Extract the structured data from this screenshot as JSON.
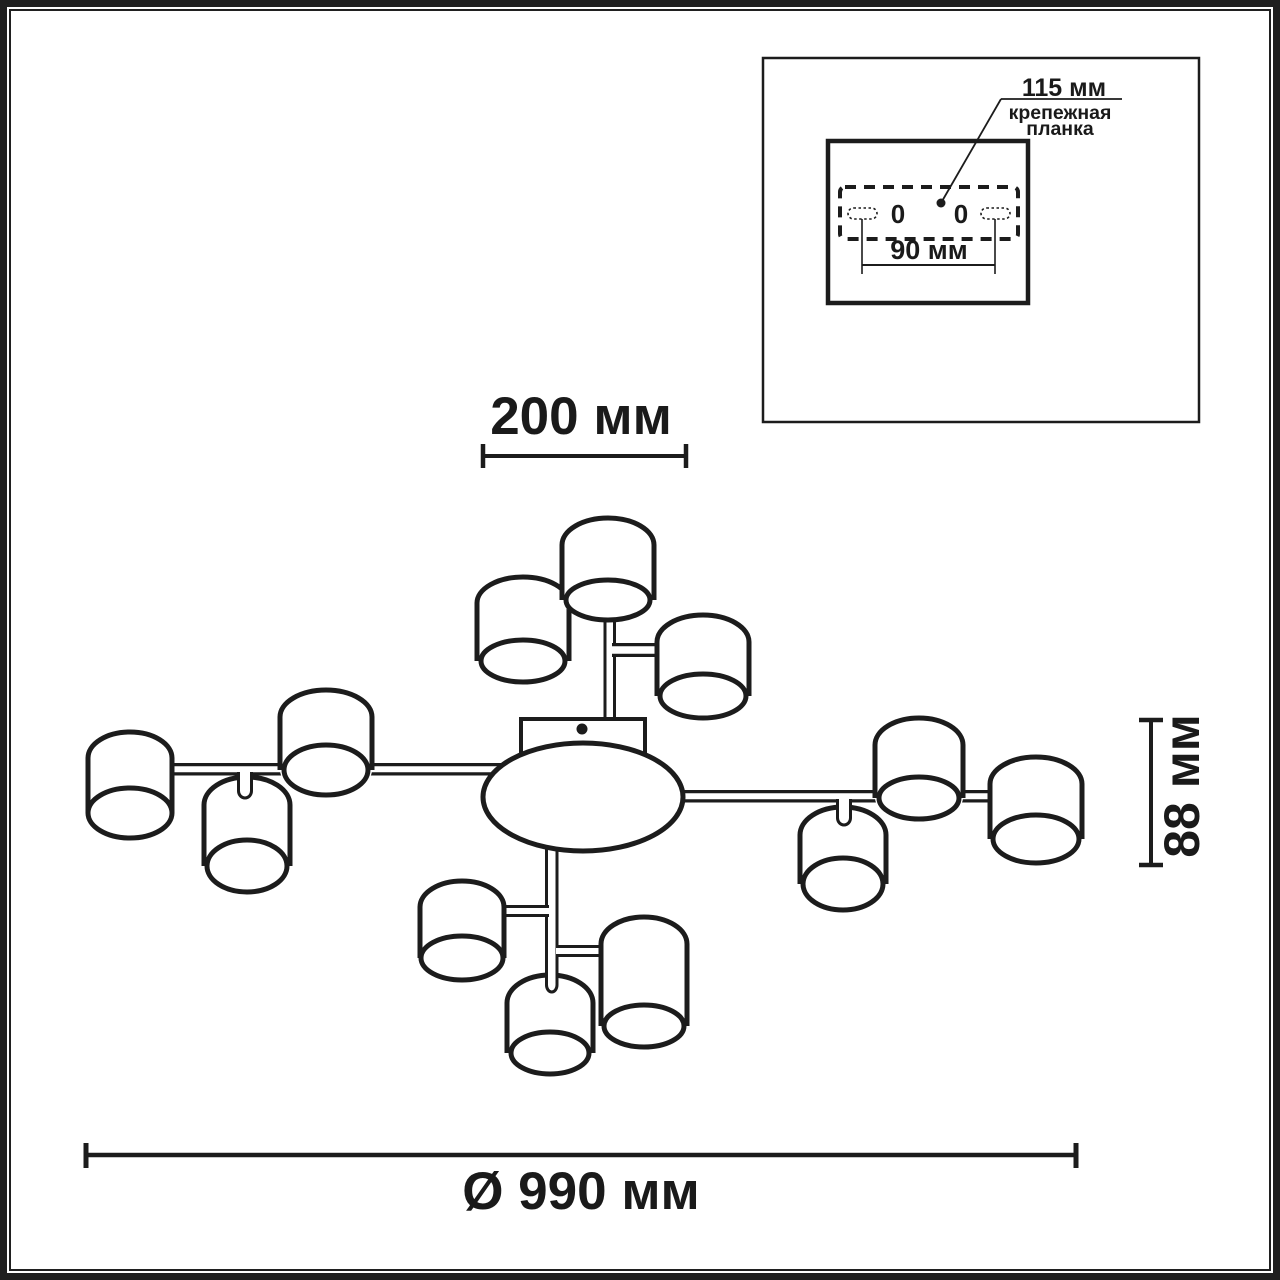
{
  "inset": {
    "hole_distance_label": "115 мм",
    "mount_label": "крепежная\nпланка",
    "span_label": "90 мм",
    "zero_marks": [
      "0",
      "0"
    ]
  },
  "dimensions": {
    "top_width": "200 мм",
    "shade_height": "88 мм",
    "diameter": "Ø 990 мм"
  },
  "drawing": {
    "stroke_color": "#1c1c1c",
    "background": "#ffffff",
    "primitives": [
      {
        "t": "rect",
        "name": "inset-box",
        "x": 763,
        "y": 58,
        "w": 436,
        "h": 364,
        "sw": 2.5,
        "fill": "#ffffff"
      },
      {
        "t": "rect",
        "name": "mount-plate-box",
        "x": 828,
        "y": 141,
        "w": 200,
        "h": 162,
        "sw": 4.5,
        "fill": "#ffffff"
      },
      {
        "t": "rect",
        "name": "mount-plate-dashed-outline",
        "x": 840,
        "y": 187,
        "w": 178,
        "h": 52,
        "sw": 4,
        "rx": 5,
        "dash": "11,8",
        "fill": "#ffffff"
      },
      {
        "t": "rect",
        "name": "mount-slot-left",
        "x": 848,
        "y": 208,
        "w": 29,
        "h": 11,
        "rx": 5.5,
        "sw": 1.6,
        "dash": "2.5,2.5",
        "fill": "#ffffff"
      },
      {
        "t": "rect",
        "name": "mount-slot-right",
        "x": 981,
        "y": 208,
        "w": 29,
        "h": 11,
        "rx": 5.5,
        "sw": 1.6,
        "dash": "2.5,2.5",
        "fill": "#ffffff"
      },
      {
        "t": "line",
        "name": "span-ext-line-left",
        "x1": 862,
        "y1": 219,
        "x2": 862,
        "y2": 274,
        "sw": 1.6
      },
      {
        "t": "line",
        "name": "span-ext-line-right",
        "x1": 995,
        "y1": 219,
        "x2": 995,
        "y2": 274,
        "sw": 1.6
      },
      {
        "t": "line",
        "name": "span-dim-line",
        "x1": 862,
        "y1": 265,
        "x2": 995,
        "y2": 265,
        "sw": 2
      },
      {
        "t": "line",
        "name": "leader-diagonal",
        "x1": 941,
        "y1": 203,
        "x2": 1001,
        "y2": 99,
        "sw": 1.8
      },
      {
        "t": "line",
        "name": "leader-horizontal",
        "x1": 1001,
        "y1": 99,
        "x2": 1122,
        "y2": 99,
        "sw": 1.8
      },
      {
        "t": "circle",
        "name": "leader-dot",
        "cx": 941,
        "cy": 203,
        "r": 4.5
      },
      {
        "t": "line",
        "name": "dim-top-line",
        "x1": 483,
        "y1": 456,
        "x2": 686,
        "y2": 456,
        "sw": 4
      },
      {
        "t": "line",
        "name": "dim-top-tick-left",
        "x1": 483,
        "y1": 444,
        "x2": 483,
        "y2": 468,
        "sw": 4.5
      },
      {
        "t": "line",
        "name": "dim-top-tick-right",
        "x1": 686,
        "y1": 444,
        "x2": 686,
        "y2": 468,
        "sw": 4.5
      },
      {
        "t": "line",
        "name": "dim-bottom-line",
        "x1": 86,
        "y1": 1155,
        "x2": 1076,
        "y2": 1155,
        "sw": 4.5
      },
      {
        "t": "line",
        "name": "dim-bottom-tick-left",
        "x1": 86,
        "y1": 1143,
        "x2": 86,
        "y2": 1168,
        "sw": 5
      },
      {
        "t": "line",
        "name": "dim-bottom-tick-right",
        "x1": 1076,
        "y1": 1143,
        "x2": 1076,
        "y2": 1168,
        "sw": 5
      },
      {
        "t": "line",
        "name": "dim-side-line",
        "x1": 1151,
        "y1": 720,
        "x2": 1151,
        "y2": 865,
        "sw": 4
      },
      {
        "t": "line",
        "name": "dim-side-tick-top",
        "x1": 1139,
        "y1": 720,
        "x2": 1163,
        "y2": 720,
        "sw": 4.5
      },
      {
        "t": "line",
        "name": "dim-side-tick-bottom",
        "x1": 1139,
        "y1": 865,
        "x2": 1163,
        "y2": 865,
        "sw": 4.5
      },
      {
        "t": "bar",
        "o": "h",
        "name": "arm-left",
        "x1": 160,
        "x2": 545,
        "y": 763,
        "th": 12.5,
        "sw": 3.2
      },
      {
        "t": "bar",
        "o": "h",
        "name": "arm-right",
        "x1": 640,
        "x2": 1050,
        "y": 790,
        "th": 12.5,
        "sw": 3.2
      },
      {
        "t": "bar",
        "o": "v",
        "name": "stem-top",
        "x": 603.5,
        "y1": 596,
        "y2": 730,
        "th": 12.5,
        "sw": 3
      },
      {
        "t": "bar",
        "o": "v",
        "name": "stem-bottom",
        "x": 545,
        "y1": 840,
        "y2": 982,
        "th": 13.5,
        "sw": 3
      },
      {
        "t": "bar",
        "o": "h",
        "name": "arm-top-right",
        "x1": 612,
        "x2": 700,
        "y": 643,
        "th": 14,
        "sw": 3.2
      },
      {
        "t": "bar",
        "o": "h",
        "name": "arm-bottom-left",
        "x1": 498,
        "x2": 549,
        "y": 905,
        "th": 12,
        "sw": 3
      },
      {
        "t": "bar",
        "o": "h",
        "name": "arm-bottom-right",
        "x1": 556,
        "x2": 615,
        "y": 945,
        "th": 12,
        "sw": 3
      },
      {
        "t": "rect",
        "name": "canopy-plate",
        "x": 521,
        "y": 719,
        "w": 124,
        "h": 52,
        "sw": 4,
        "fill": "#ffffff"
      },
      {
        "t": "circle",
        "name": "canopy-screw-dot",
        "cx": 582,
        "cy": 729,
        "r": 5.5
      },
      {
        "t": "ellipse",
        "name": "center-body",
        "cx": 583,
        "cy": 797,
        "rx": 100,
        "ry": 54,
        "sw": 5,
        "fill": "#ffffff"
      },
      {
        "t": "shade",
        "name": "lampshade-top-left",
        "cx": 523,
        "rx": 46,
        "top": 577,
        "ryt": 26,
        "bcy": 661,
        "brx": 42,
        "bry": 21,
        "sw": 5
      },
      {
        "t": "shade",
        "name": "lampshade-top-center",
        "cx": 608,
        "rx": 46,
        "top": 518,
        "ryt": 27,
        "bcy": 600,
        "brx": 42,
        "bry": 20,
        "sw": 5
      },
      {
        "t": "shade",
        "name": "lampshade-top-right",
        "cx": 703,
        "rx": 46,
        "top": 615,
        "ryt": 27,
        "bcy": 696,
        "brx": 43,
        "bry": 22,
        "sw": 5
      },
      {
        "t": "shade",
        "name": "lampshade-left-hanging",
        "cx": 247,
        "rx": 43,
        "top": 777,
        "ryt": 28,
        "bcy": 866,
        "brx": 40,
        "bry": 26,
        "sw": 5
      },
      {
        "t": "shade",
        "name": "lampshade-left-upper",
        "cx": 326,
        "rx": 46,
        "top": 690,
        "ryt": 27,
        "bcy": 770,
        "brx": 42,
        "bry": 25,
        "sw": 5
      },
      {
        "t": "shade",
        "name": "lampshade-far-left",
        "cx": 130,
        "rx": 42,
        "top": 732,
        "ryt": 26,
        "bcy": 813,
        "brx": 42,
        "bry": 25,
        "sw": 5
      },
      {
        "t": "shade",
        "name": "lampshade-right-hanging",
        "cx": 843,
        "rx": 43,
        "top": 807,
        "ryt": 28,
        "bcy": 884,
        "brx": 40,
        "bry": 26,
        "sw": 5
      },
      {
        "t": "shade",
        "name": "lampshade-right-upper",
        "cx": 919,
        "rx": 44,
        "top": 718,
        "ryt": 27,
        "bcy": 798,
        "brx": 40,
        "bry": 21,
        "sw": 5
      },
      {
        "t": "shade",
        "name": "lampshade-far-right",
        "cx": 1036,
        "rx": 46,
        "top": 757,
        "ryt": 27,
        "bcy": 839,
        "brx": 43,
        "bry": 24,
        "sw": 5
      },
      {
        "t": "shade",
        "name": "lampshade-bottom-left",
        "cx": 462,
        "rx": 42,
        "top": 881,
        "ryt": 26,
        "bcy": 958,
        "brx": 41,
        "bry": 22,
        "sw": 5
      },
      {
        "t": "shade",
        "name": "lampshade-bottom-right",
        "cx": 644,
        "rx": 43,
        "top": 917,
        "ryt": 27,
        "bcy": 1026,
        "brx": 40,
        "bry": 21,
        "sw": 5
      },
      {
        "t": "shade",
        "name": "lampshade-bottom-center",
        "cx": 550,
        "rx": 43,
        "top": 975,
        "ryt": 28,
        "bcy": 1053,
        "brx": 39,
        "bry": 21,
        "sw": 5
      },
      {
        "t": "path",
        "name": "stem-bottom-tip",
        "d": "M 546.5 955 L 546.5 985 A 5.25 7 0 0 0 557 985 L 557 955",
        "fill": "#ffffff",
        "sw": 3
      },
      {
        "t": "path",
        "name": "nub-left-hanging",
        "d": "M 238.5 772 L 238.5 791 A 6.5 7 0 0 0 251.5 791 L 251.5 772",
        "fill": "#ffffff",
        "sw": 3
      },
      {
        "t": "path",
        "name": "nub-right-hanging",
        "d": "M 837.5 799 L 837.5 818 A 6.5 7 0 0 0 850.5 818 L 850.5 799",
        "fill": "#ffffff",
        "sw": 3
      }
    ]
  }
}
